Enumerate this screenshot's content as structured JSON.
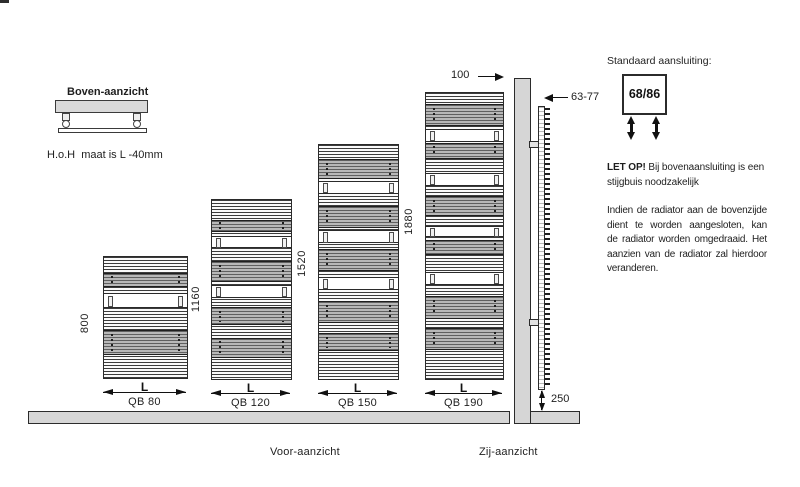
{
  "colors": {
    "structure_gray": "#d6d6d6",
    "slat_gray": "#a8a8a8",
    "line_dark": "#222222"
  },
  "top_view": {
    "title": "Boven-aanzicht",
    "note": "H.o.H  maat is L -40mm"
  },
  "front_view": {
    "caption": "Voor-aanzicht",
    "radiators": [
      {
        "height_mm": "800",
        "width_label": "L",
        "model": "QB 80"
      },
      {
        "height_mm": "1160",
        "width_label": "L",
        "model": "QB 120"
      },
      {
        "height_mm": "1520",
        "width_label": "L",
        "model": "QB 150"
      },
      {
        "height_mm": "1880",
        "width_label": "L",
        "model": "QB 190"
      }
    ]
  },
  "side_view": {
    "caption": "Zij-aanzicht",
    "top_offset": "100",
    "depth_range": "63-77",
    "bottom_clearance": "250"
  },
  "connection_info": {
    "heading": "Standaard aansluiting:",
    "connection_size": "68/86",
    "notice_bold": "LET OP!",
    "notice_line1_rest": " Bij bovenaansluiting is een",
    "notice_line2": "stijgbuis noodzakelijk",
    "description_lines": [
      "Indien de radiator aan de bovenzijde",
      "dient  te  worden  aangesloten,  kan",
      "de radiator worden omgedraaid. Het",
      "aanzien van de radiator zal hierdoor",
      "veranderen."
    ]
  }
}
